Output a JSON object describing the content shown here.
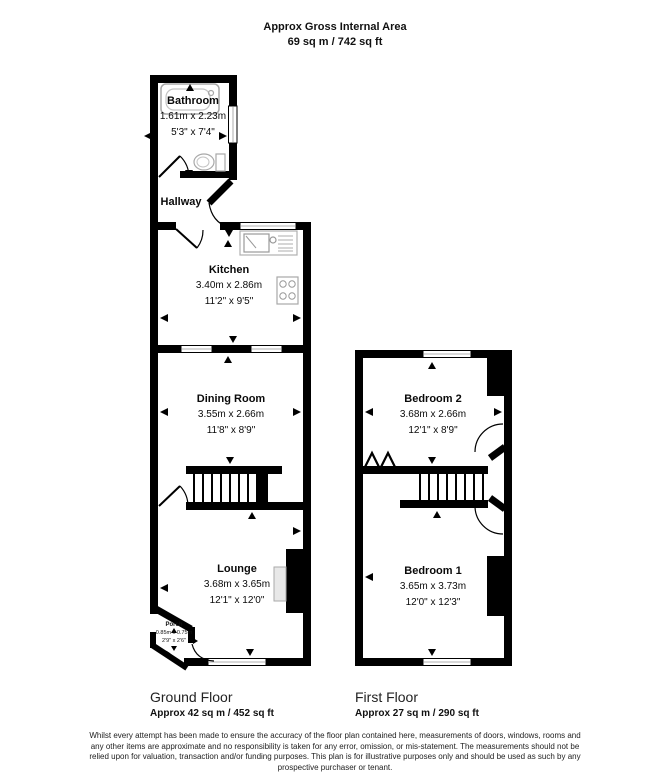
{
  "title": {
    "line1": "Approx Gross Internal Area",
    "line2": "69 sq m / 742 sq ft"
  },
  "ground_floor": {
    "name": "Ground Floor",
    "area": "Approx 42 sq m / 452 sq ft",
    "rooms": {
      "bathroom": {
        "name": "Bathroom",
        "metric": "1.61m x 2.23m",
        "imperial": "5'3\" x 7'4\""
      },
      "hallway": {
        "name": "Hallway"
      },
      "kitchen": {
        "name": "Kitchen",
        "metric": "3.40m x 2.86m",
        "imperial": "11'2\" x 9'5\""
      },
      "dining_room": {
        "name": "Dining Room",
        "metric": "3.55m x 2.66m",
        "imperial": "11'8\" x 8'9\""
      },
      "lounge": {
        "name": "Lounge",
        "metric": "3.68m x 3.65m",
        "imperial": "12'1\" x 12'0\""
      },
      "porch": {
        "name": "Porch",
        "metric": "0.85m x 0.75m",
        "imperial": "2'9\" x 2'6\""
      }
    }
  },
  "first_floor": {
    "name": "First Floor",
    "area": "Approx 27 sq m / 290 sq ft",
    "rooms": {
      "bedroom2": {
        "name": "Bedroom 2",
        "metric": "3.68m x 2.66m",
        "imperial": "12'1\" x 8'9\""
      },
      "bedroom1": {
        "name": "Bedroom 1",
        "metric": "3.65m x 3.73m",
        "imperial": "12'0\" x 12'3\""
      }
    }
  },
  "disclaimer": {
    "line1": "Whilst every attempt has been made to ensure the accuracy of the floor plan contained here, measurements of doors, windows, rooms and",
    "line2": "any other items are approximate and no responsibility is taken for any error, omission, or mis-statement. The measurements should not be",
    "line3": "relied upon for valuation, transaction and/or funding purposes. This plan is for illustrative purposes only and should be used as such by any",
    "line4": "prospective purchaser or tenant."
  },
  "colors": {
    "wall": "#000000",
    "background": "#ffffff",
    "fixture_stroke": "#a8a8a8",
    "fireplace_fill": "#e8e8e8"
  }
}
